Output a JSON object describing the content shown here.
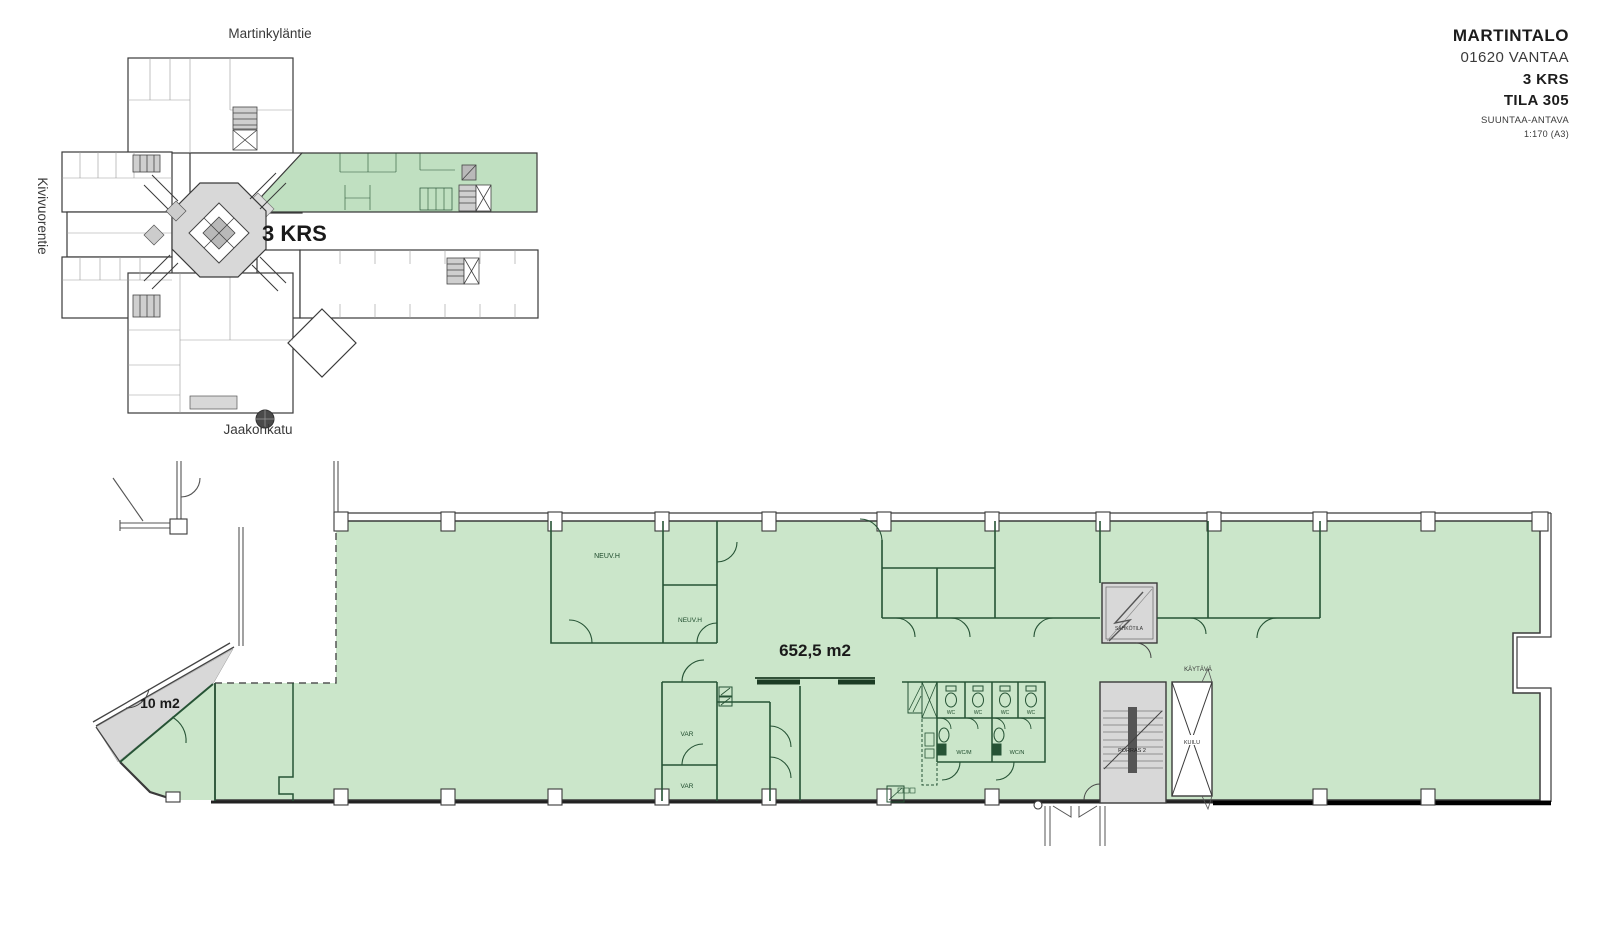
{
  "title_block": {
    "building": "MARTINTALO",
    "address": "01620 VANTAA",
    "floor": "3 KRS",
    "space": "TILA 305",
    "note": "SUUNTAA-ANTAVA",
    "scale": "1:170 (A3)"
  },
  "overview_plan": {
    "street_top": "Martinkyläntie",
    "street_left": "Kivivuorentie",
    "street_bottom": "Jaakonkatu",
    "floor_label": "3 KRS"
  },
  "floor_plan": {
    "total_area": "652,5 m2",
    "entry_area": "10 m2",
    "rooms": {
      "meeting_room_large": "NEUV.H",
      "meeting_room_small": "NEUV.H",
      "storage_upper": "VAR",
      "storage_lower": "VAR",
      "wc_stall": "WC",
      "wc_men": "WC/M",
      "wc_women": "WC/N",
      "electrical_room": "SÄHKÖTILA",
      "corridor": "KÄYTÄVÄ",
      "stairs": "PORRAS 2",
      "shaft": "KUILU"
    }
  },
  "colors": {
    "highlight_green": "#cbe6ca",
    "overview_green": "#c0e0c1",
    "room_gray": "#d8d8d8",
    "wall_dark": "#3a3a3a",
    "wall_green": "#265335"
  }
}
